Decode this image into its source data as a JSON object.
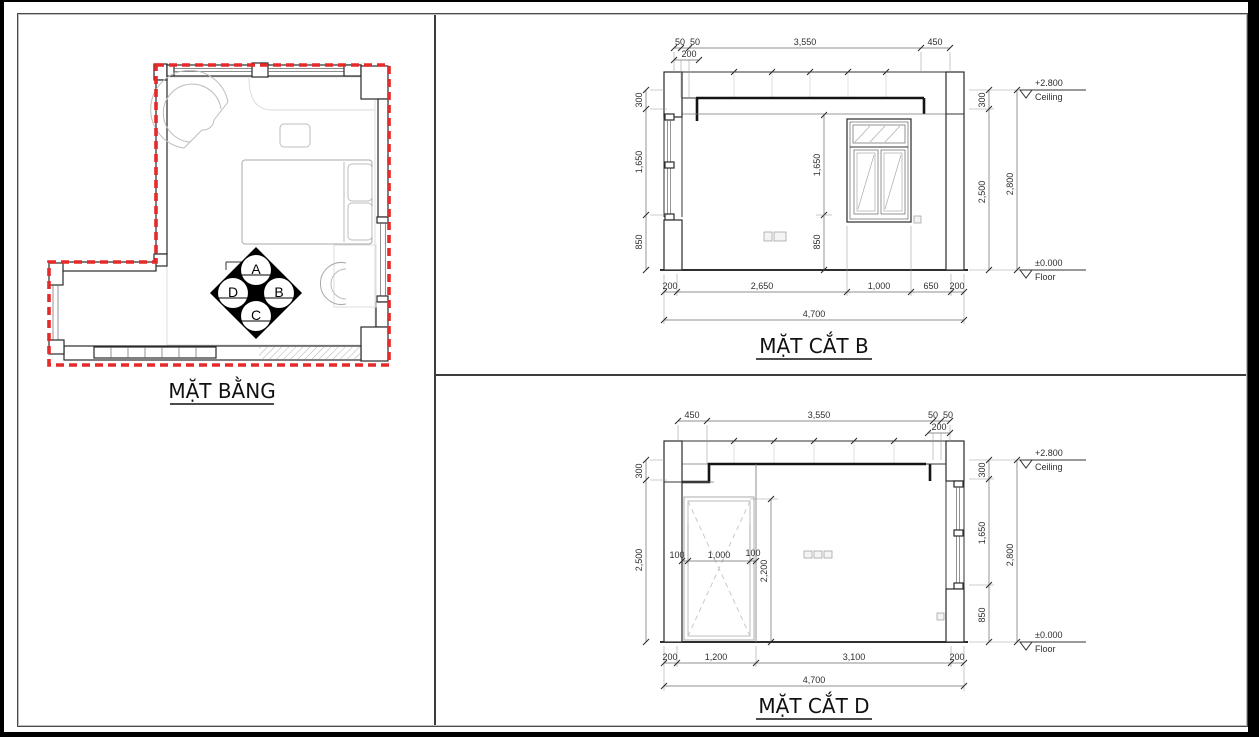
{
  "colors": {
    "boundary_red": "#e62a2a",
    "wall_line": "#2a2a2a",
    "furniture_line": "#bdbdbd",
    "dim_text": "#2e2e2e"
  },
  "plan": {
    "title": "MẶT BẰNG",
    "marker": {
      "top": "A",
      "right": "B",
      "bottom": "C",
      "left": "D"
    }
  },
  "section_b": {
    "title": "MẶT CẮT B",
    "top_dims": [
      "50",
      "50",
      "3,550",
      "450"
    ],
    "top_dim_sub": "200",
    "left_dims": [
      "300",
      "1,650",
      "850"
    ],
    "inner_dims": [
      "1,650",
      "850"
    ],
    "bottom_dims": [
      "200",
      "2,650",
      "1,000",
      "650",
      "200"
    ],
    "bottom_total": "4,700",
    "right_dims": [
      "300",
      "2,500"
    ],
    "right_total": "2,800",
    "levels": {
      "ceiling_value": "+2.800",
      "ceiling_label": "Ceiling",
      "floor_value": "±0.000",
      "floor_label": "Floor"
    }
  },
  "section_d": {
    "title": "MẶT CẮT D",
    "top_dims": [
      "450",
      "3,550",
      "50",
      "50"
    ],
    "top_dim_sub": "200",
    "left_dims": [
      "300",
      "2,500"
    ],
    "inner_width_dims": [
      "100",
      "1,000",
      "100"
    ],
    "inner_height_dim": "2,200",
    "bottom_dims": [
      "200",
      "1,200",
      "3,100",
      "200"
    ],
    "bottom_total": "4,700",
    "right_dims": [
      "300",
      "1,650",
      "850"
    ],
    "right_total": "2,800",
    "levels": {
      "ceiling_value": "+2.800",
      "ceiling_label": "Ceiling",
      "floor_value": "±0.000",
      "floor_label": "Floor"
    }
  }
}
